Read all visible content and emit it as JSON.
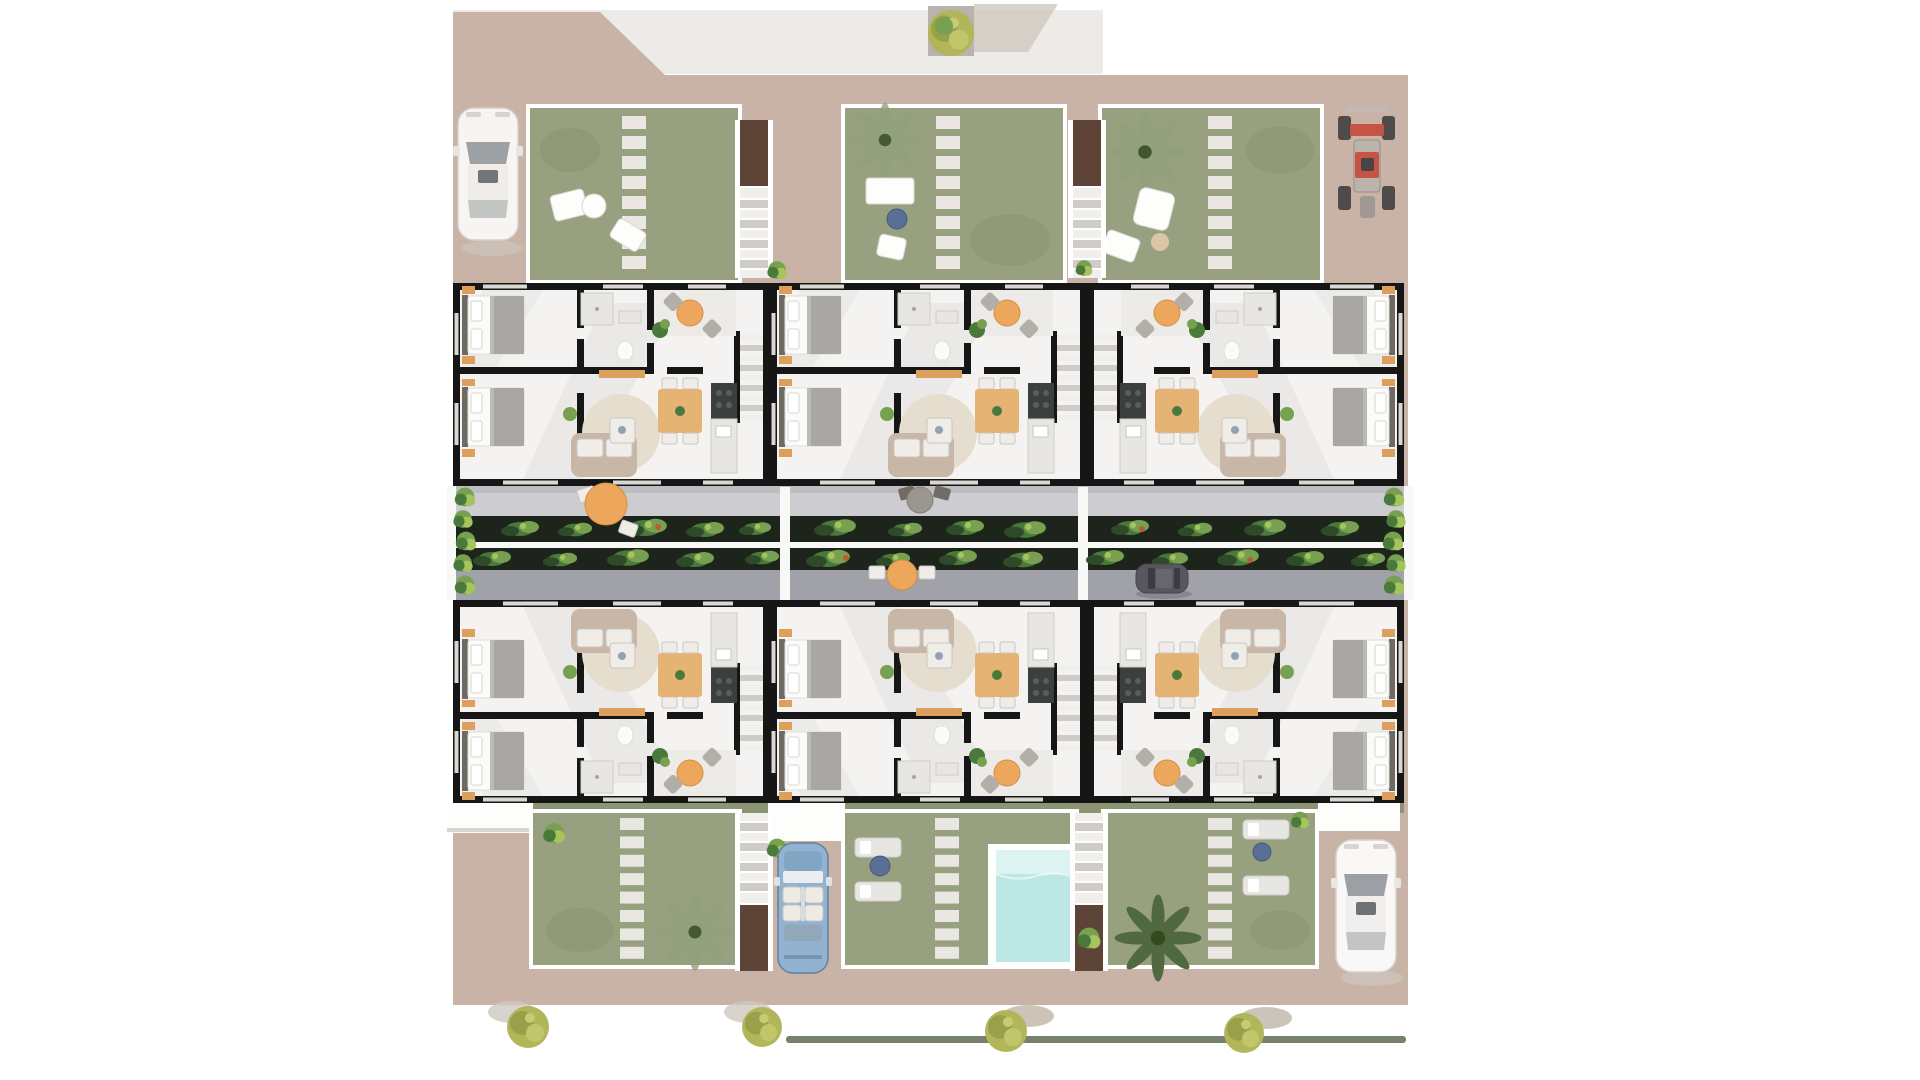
{
  "site": {
    "type": "residential-development-floor-plan",
    "building_rows": 2,
    "apartment_units_per_row": 3,
    "apartment_units_total": 6,
    "gardens_top": 3,
    "gardens_bottom": 3,
    "bedrooms_per_unit": 2,
    "staircases": 4,
    "pool_count": 1,
    "vehicles": [
      {
        "name": "white-car-top-left",
        "color_key": "white_car"
      },
      {
        "name": "red-quad-top-right",
        "color_key": "red"
      },
      {
        "name": "dark-car-central-street",
        "color_key": "dark_car"
      },
      {
        "name": "blue-convertible-bottom-center",
        "color_key": "blue_car"
      },
      {
        "name": "white-car-bottom-right",
        "color_key": "white_car"
      }
    ],
    "amenities": [
      "central-pedestrian-street",
      "street-planters",
      "terraces-with-tables",
      "stepping-stone-paths",
      "sun-loungers",
      "swimming-pool"
    ],
    "vegetation": [
      "top-street-tree",
      "garden-palms",
      "street-planter-shrubs",
      "boundary-bushes",
      "four-yellow-green-trees-bottom",
      "bottom-hedge-line"
    ]
  },
  "colors": {
    "bg": "#ffffff",
    "sidewalk": "#edebe7",
    "tan": "#c9b2a6",
    "garden": "#97a17f",
    "garden_dark": "#87926c",
    "frame": "#ffffff",
    "stone": "#eae7e2",
    "wall": "#161616",
    "floor": "#f4f3f1",
    "street_light": "#cdccd1",
    "street_dark": "#a0a1a9",
    "planter": "#1d241b",
    "divider": "#f8f8f7",
    "hedge": "#8b9573",
    "hedge_dark": "#5e6b53",
    "pool": "#bce7e4",
    "pool_light": "#dcf3f1",
    "orange": "#eda75c",
    "wood": "#e5b474",
    "sofa": "#c8b7a6",
    "rug": "#e5decf",
    "cushion": "#f0ede8",
    "kitchen": "#3b403f",
    "counter": "#e8e6e2",
    "bed_white": "#fbfbfa",
    "bed_blanket": "#a9a7a4",
    "headboard": "#6e6962",
    "nightstand": "#dca05c",
    "chair_gray": "#b3afa8",
    "chair_dark": "#716d66",
    "table_gray": "#9b978f",
    "white_car": "#fcfcfb",
    "car_glass": "#9aa0a4",
    "car_line": "#d9d7d3",
    "blue_car": "#8fb4d4",
    "blue_car_dark": "#5d7f9e",
    "dark_car": "#57575d",
    "red": "#c64434",
    "wheel": "#3a3a3a",
    "palm": "#51693f",
    "palm_faded": "#93a07c",
    "plant_a": "#4a7a3b",
    "plant_b": "#77a050",
    "plant_c": "#a5c45e",
    "tree": "#b2b65b",
    "tree_dark": "#99a04a",
    "shadow": "#cfc8c1",
    "blue_table": "#5a6f96",
    "patio": "#fdfdfc",
    "patio_line": "#d9d6d1",
    "stair_brown": "#5e4436",
    "tread": "#f1efec",
    "tread_gap": "#cfccc7",
    "planter_gray": "#b9b3ad"
  }
}
